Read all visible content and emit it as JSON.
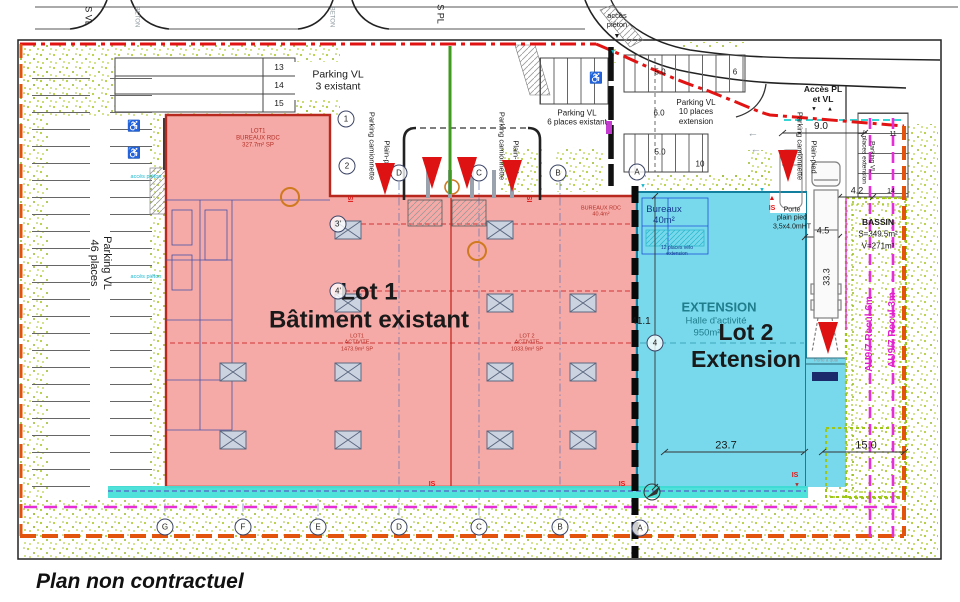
{
  "caption": "Plan non contractuel",
  "colors": {
    "lot1_fill": "#f6aaa7",
    "lot1_border": "#b8281e",
    "lot2_fill": "#79d9ec",
    "lot2_border": "#127f9e",
    "boundary_red": "#e21313",
    "limit_orange": "#e2540e",
    "recul_magenta": "#e62ed6",
    "cyan_strip": "#45e0d8",
    "stipple_green": "#b5cf3e"
  },
  "roads": {
    "label_svl": "S VL",
    "label_spl": "S PL",
    "beton_1": "BETON",
    "beton_2": "BETON"
  },
  "access": {
    "pieton_top": "accès\npiéton",
    "pieton_left_1": "accès piéton",
    "pieton_left_2": "accès piéton",
    "pl_vl": "Accès PL\net VL"
  },
  "parking": {
    "small": {
      "rows": [
        "13",
        "14",
        "15"
      ],
      "label": "Parking VL\n3 existant"
    },
    "left": {
      "label": "Parking VL\n46 places"
    },
    "six": {
      "label": "Parking VL\n6 places existant"
    },
    "ten": {
      "label": "Parking VL\n10 places\nextension",
      "dim_top": "5.0",
      "dim_mid": "6.0",
      "dim_bot": "5.0",
      "stall_6": "6",
      "stall_10": "10"
    },
    "four": {
      "label": "Parking VL\n4 places extension",
      "stall_11": "11",
      "stall_14": "14"
    }
  },
  "canopy": {
    "plain_pied": [
      "Plain-pied",
      "Plain-pied",
      "Plain-pied"
    ],
    "camionnette": [
      "Parking camionnette",
      "Parking camionnette",
      "Parking camionnette"
    ]
  },
  "lot1": {
    "title": "Lot 1\nBâtiment existant",
    "bureaux_rdc": "LOT1\nBUREAUX RDC\n327.7m² SP",
    "activite1": "LOT1\nACTIVITE\n1473.9m² SP",
    "activite2": "LOT 2\nACTIVITE\n1033.9m² SP",
    "bureaux_40": "BUREAUX RDC\n40.4m²"
  },
  "lot2": {
    "title": "Lot 2\nExtension",
    "extension_label": "EXTENSION",
    "halle": "Halle d'activité",
    "surface": "950m²",
    "bureaux": "Bureaux\n40m²",
    "velo": "12 places vélo\nextension",
    "porte": "Porte\nplain pied\n3,5x4.0mHT",
    "porte_quai": "Porte à quai"
  },
  "bassin": {
    "title": "BASSIN",
    "surface": "S=349.5m²",
    "volume": "V=271m³"
  },
  "recul": {
    "line_3m": "AU9/7 Recul 3m",
    "line_6m": "AU9/7 Recul 6m"
  },
  "dims": {
    "d9": "9.0",
    "d42": "4.2",
    "d45": "4.5",
    "d333": "33.3",
    "d411": "41.1",
    "d237": "23.7",
    "d150": "15.0"
  },
  "grid": {
    "top": [
      "D",
      "C",
      "B",
      "A"
    ],
    "bottom": [
      "G",
      "F",
      "E",
      "D",
      "C",
      "B",
      "A"
    ],
    "left": [
      "1",
      "2",
      "3'",
      "4'"
    ],
    "axis4": "4"
  },
  "is_labels": [
    "IS",
    "IS",
    "IS",
    "IS",
    "IS",
    "IS"
  ]
}
